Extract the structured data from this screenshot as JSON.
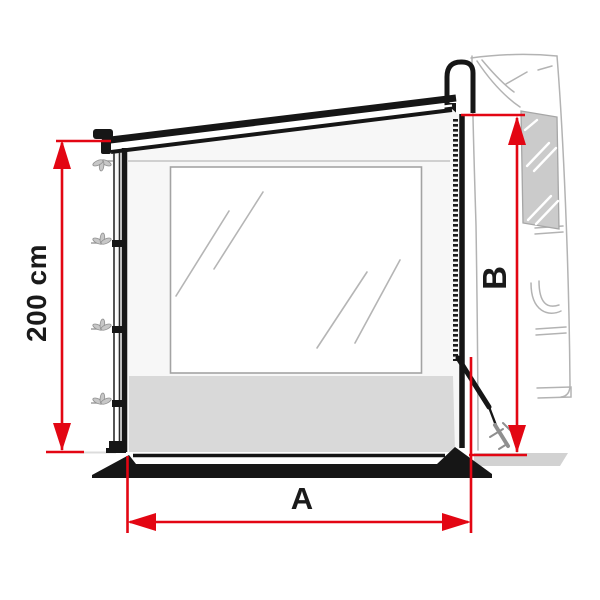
{
  "page": {
    "background": "#ffffff",
    "title": "Awning side panel dimension diagram"
  },
  "diagram": {
    "kind": "technical line drawing",
    "subject": "Caravan awning side panel with large window, front support pole with fixing hooks, zipper attachment to the awning case, tension strap with ground peg, shown against a sketched vehicle side wall",
    "labels": {
      "height": "200 cm",
      "width": "A",
      "rear_height": "B"
    },
    "colors": {
      "dimension_red": "#e30613",
      "drawing_black": "#161616",
      "vehicle_sketch_gray": "#b3b3b3",
      "window_fill_gray": "#cbcbcb",
      "skirt_gray": "#d9d9d9",
      "ground_gray": "#d2d2d2",
      "panel_fill": "#f7f7f7",
      "window_glass_white": "#ffffff"
    }
  }
}
